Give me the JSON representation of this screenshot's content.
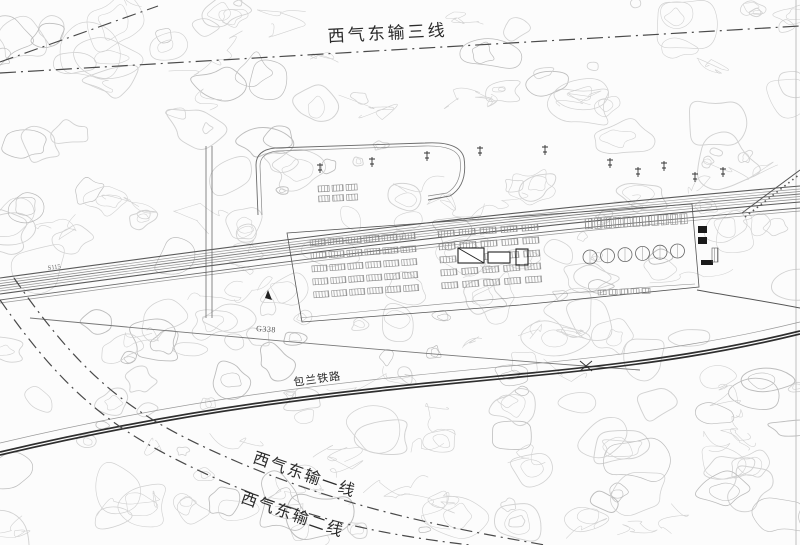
{
  "labels": {
    "pipeline_line3": "西气东输三线",
    "pipeline_line1": "西气东输一线",
    "pipeline_line2": "西气东输二线",
    "railway": "包兰铁路",
    "road_main": "G338",
    "road_left": "S115"
  },
  "colors": {
    "background": "#fcfcfc",
    "contour": "#d2d2d2",
    "contour_dark": "#bdbdbd",
    "road": "#5a5a5a",
    "railway": "#2e2e2e",
    "pipeline": "#4a4a4a",
    "text": "#2b2b2b"
  }
}
